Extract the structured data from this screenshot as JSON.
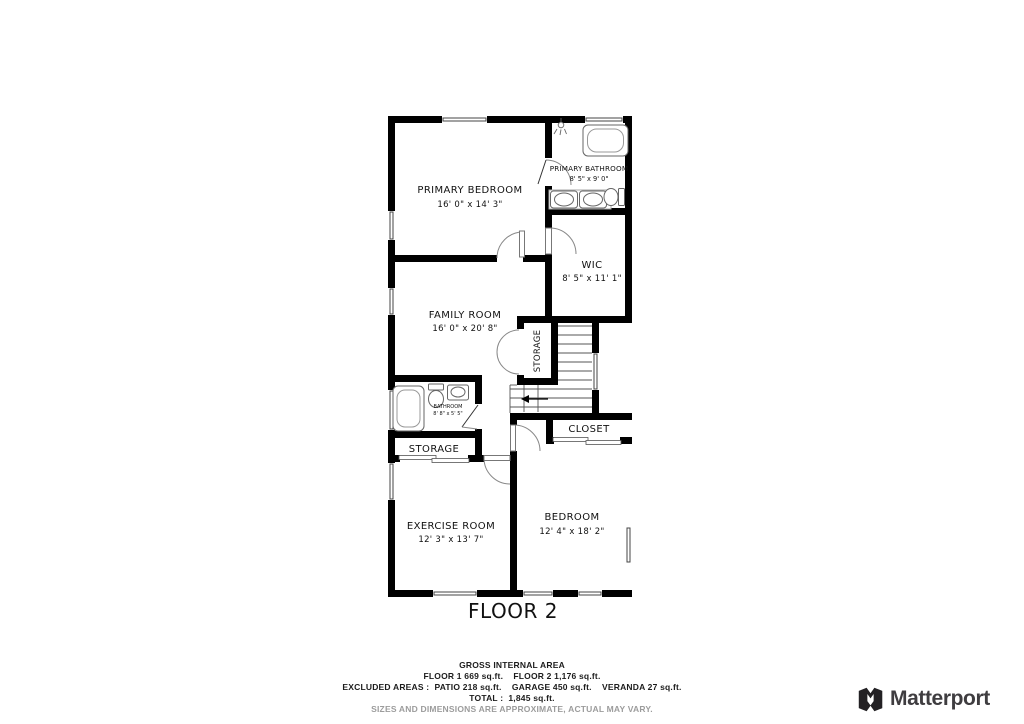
{
  "floor_label": "FLOOR 2",
  "rooms": {
    "primary_bedroom": {
      "name": "PRIMARY BEDROOM",
      "dims": "16' 0\" x 14' 3\""
    },
    "primary_bathroom": {
      "name": "PRIMARY BATHROOM",
      "dims": "8' 5\" x 9' 0\""
    },
    "wic": {
      "name": "WIC",
      "dims": "8' 5\" x 11' 1\""
    },
    "family_room": {
      "name": "FAMILY ROOM",
      "dims": "16' 0\" x 20' 8\""
    },
    "bathroom": {
      "name": "BATHROOM",
      "dims": "8' 8\" x 5' 5\""
    },
    "storage_center": {
      "name": "STORAGE"
    },
    "storage_left": {
      "name": "STORAGE"
    },
    "closet": {
      "name": "CLOSET"
    },
    "exercise_room": {
      "name": "EXERCISE ROOM",
      "dims": "12' 3\" x 13' 7\""
    },
    "bedroom": {
      "name": "BEDROOM",
      "dims": "12' 4\" x 18' 2\""
    }
  },
  "footer": {
    "title": "GROSS INTERNAL AREA",
    "line1": "FLOOR 1 669 sq.ft.    FLOOR 2 1,176 sq.ft.",
    "line2": "EXCLUDED AREAS :  PATIO 218 sq.ft.    GARAGE 450 sq.ft.    VERANDA 27 sq.ft.",
    "line3": "TOTAL :  1,845 sq.ft.",
    "disclaimer": "SIZES AND DIMENSIONS ARE APPROXIMATE, ACTUAL MAY VARY."
  },
  "branding": {
    "logo_text": "Matterport"
  },
  "colors": {
    "wall": "#000000",
    "fixture_stroke": "#666666",
    "disclaimer_gray": "#9c9c9c",
    "logo_dark": "#232124"
  }
}
